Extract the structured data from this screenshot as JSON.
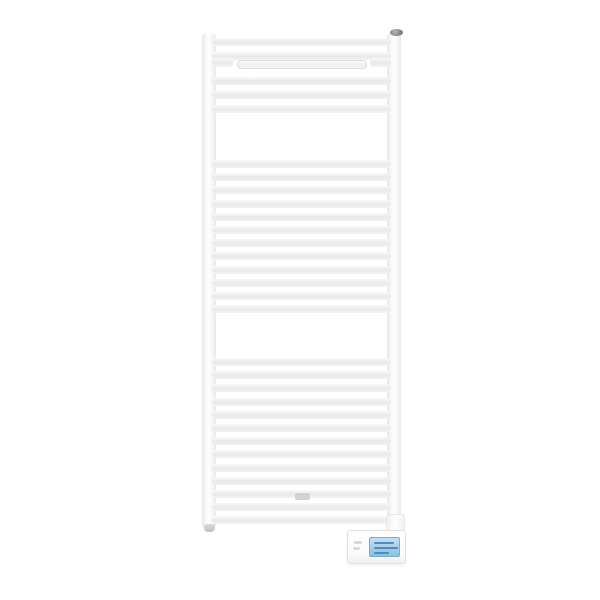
{
  "scene": {
    "background_color": "#ffffff",
    "subject": "white-ladder-towel-radiator",
    "radiator": {
      "x": 202,
      "y": 33,
      "width": 199,
      "height": 495,
      "rail_width": 14,
      "bar_x": 212,
      "bar_width": 179,
      "bar_height": 8,
      "bar_groups": [
        {
          "start_y": 38,
          "pitch": 13.5,
          "count": 2
        },
        {
          "start_y": 77,
          "pitch": 14,
          "count": 3
        },
        {
          "start_y": 160,
          "pitch": 13.2,
          "count": 12
        },
        {
          "start_y": 358,
          "pitch": 13.2,
          "count": 13
        }
      ],
      "hanger": {
        "stub_y": 58,
        "stub_width": 21,
        "stub_height": 9,
        "inset_x": 237,
        "inset_y": 60,
        "inset_width": 130,
        "inset_height": 9
      }
    },
    "vent_cap": {
      "x": 390,
      "y": 29,
      "width": 13,
      "height": 7,
      "color": "#7f7f7f",
      "highlight": "#b8b8b8"
    },
    "pipe_nub": {
      "x": 204,
      "y": 524,
      "width": 11,
      "height": 8,
      "color": "#c0c0c0"
    },
    "cable_clip": {
      "x": 295,
      "y": 493,
      "width": 15,
      "height": 7,
      "color": "#d2d2d2"
    },
    "rail_end_cap": {
      "x": 386,
      "y": 514,
      "width": 19,
      "height": 17
    },
    "control_unit": {
      "x": 347,
      "y": 530,
      "width": 59,
      "height": 34,
      "screen": {
        "x": 21,
        "y": 6,
        "width": 31,
        "height": 20,
        "top_color": "#c6e0f2",
        "bottom_color": "#8abfe2",
        "border_color": "#79aed3",
        "line_color": "#4e8cbe",
        "line_widths": [
          20,
          24,
          15
        ]
      },
      "button_color": "#d9d9d9",
      "buttons": [
        {
          "x": 6,
          "y": 10,
          "width": 8,
          "height": 3
        },
        {
          "x": 5,
          "y": 16,
          "width": 7,
          "height": 3
        }
      ]
    }
  }
}
